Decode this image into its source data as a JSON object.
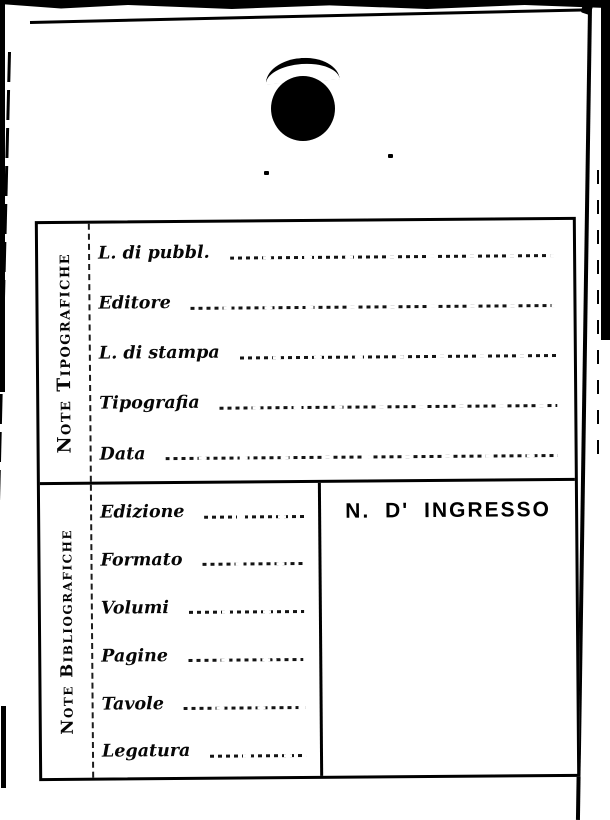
{
  "document": {
    "kind": "library-accession-card",
    "paper_color": "#ffffff",
    "ink_color": "#000000",
    "sections": [
      {
        "side_label": "Note Tipografiche",
        "fields": [
          "L. di pubbl.",
          "Editore",
          "L. di stampa",
          "Tipografia",
          "Data"
        ],
        "field_values": [
          "",
          "",
          "",
          "",
          ""
        ]
      },
      {
        "side_label": "Note Bibliografiche",
        "fields": [
          "Edizione",
          "Formato",
          "Volumi",
          "Pagine",
          "Tavole",
          "Legatura"
        ],
        "field_values": [
          "",
          "",
          "",
          "",
          "",
          ""
        ],
        "ingresso_title": "N. D' INGRESSO",
        "ingresso_value": ""
      }
    ]
  }
}
